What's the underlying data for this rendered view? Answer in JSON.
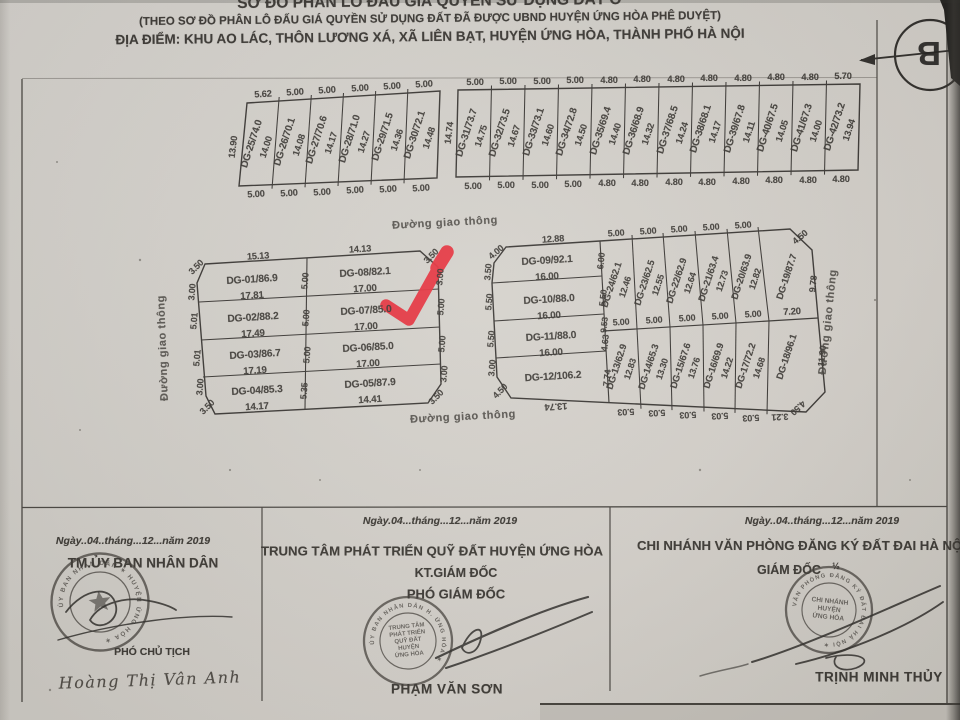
{
  "title": {
    "line1": "SƠ ĐỒ PHÂN LÔ ĐẤU GIÁ QUYỀN SỬ DỤNG ĐẤT Ở",
    "line2": "(THEO SƠ ĐỒ PHÂN LÔ ĐẤU GIÁ QUYỀN SỬ DỤNG ĐẤT ĐÃ ĐƯỢC UBND HUYỆN ỨNG HÒA PHÊ DUYỆT)",
    "line3": "ĐỊA ĐIỂM: KHU AO LÁC, THÔN LƯƠNG XÁ, XÃ LIÊN BẠT, HUYỆN ỨNG HÒA, THÀNH PHỐ HÀ NỘI"
  },
  "compass": {
    "north_label": "B"
  },
  "road_label": "Đường giao thông",
  "colors": {
    "paper": "#d7d3cd",
    "ink": "#3a3733",
    "red_mark": "#e6323e"
  },
  "blocks": {
    "top_left": {
      "left_dim": "13.90",
      "top_dims": [
        "5.62",
        "5.00",
        "5.00",
        "5.00",
        "5.00",
        "5.00"
      ],
      "bottom_dims": [
        "5.00",
        "5.00",
        "5.00",
        "5.00",
        "5.00",
        "5.00"
      ],
      "plots": [
        {
          "id": "DG-25/74.0",
          "depth": "14.00"
        },
        {
          "id": "DG-26/70.1",
          "depth": "14.08"
        },
        {
          "id": "DG-27/70.6",
          "depth": "14.17"
        },
        {
          "id": "DG-28/71.0",
          "depth": "14.27"
        },
        {
          "id": "DG-29/71.5",
          "depth": "14.36"
        },
        {
          "id": "DG-30/72.1",
          "depth": "14.48"
        }
      ]
    },
    "top_right": {
      "left_dim": "14.74",
      "top_dims": [
        "5.00",
        "5.00",
        "5.00",
        "5.00",
        "4.80",
        "4.80",
        "4.80",
        "4.80",
        "4.80",
        "4.80",
        "4.80",
        "5.70"
      ],
      "bottom_dims": [
        "5.00",
        "5.00",
        "5.00",
        "5.00",
        "4.80",
        "4.80",
        "4.80",
        "4.80",
        "4.80",
        "4.80",
        "4.80",
        "4.80"
      ],
      "plots": [
        {
          "id": "DG-31/73.7",
          "depth": "14.75"
        },
        {
          "id": "DG-32/73.5",
          "depth": "14.67"
        },
        {
          "id": "DG-33/73.1",
          "depth": "14.60"
        },
        {
          "id": "DG-34/72.8",
          "depth": "14.50"
        },
        {
          "id": "DG-35/69.4",
          "depth": "14.40"
        },
        {
          "id": "DG-36/68.9",
          "depth": "14.32"
        },
        {
          "id": "DG-37/68.5",
          "depth": "14.24"
        },
        {
          "id": "DG-38/68.1",
          "depth": "14.17"
        },
        {
          "id": "DG-39/67.8",
          "depth": "14.11"
        },
        {
          "id": "DG-40/67.5",
          "depth": "14.05"
        },
        {
          "id": "DG-41/67.3",
          "depth": "14.00"
        },
        {
          "id": "DG-42/73.2",
          "depth": "13.94"
        }
      ]
    },
    "mid_left": {
      "top_dims": [
        "15.13",
        "14.13"
      ],
      "left_col": [
        {
          "id": "DG-01/86.9",
          "w": "17.81"
        },
        {
          "id": "DG-02/88.2",
          "w": "17.49"
        },
        {
          "id": "DG-03/86.7",
          "w": "17.19"
        },
        {
          "id": "DG-04/85.3",
          "w": "14.17"
        }
      ],
      "right_col": [
        {
          "id": "DG-08/82.1",
          "w": "17.00"
        },
        {
          "id": "DG-07/85.0",
          "w": "17.00"
        },
        {
          "id": "DG-06/85.0",
          "w": "17.00"
        },
        {
          "id": "DG-05/87.9",
          "w": "14.41"
        }
      ],
      "left_dims": [
        "3.50",
        "3.00",
        "5.01",
        "5.01",
        "3.00",
        "3.50"
      ],
      "mid_dims": [
        "5.00",
        "5.00",
        "5.00",
        "5.35"
      ],
      "right_dims": [
        "3.50",
        "3.00",
        "5.00",
        "5.00",
        "3.00",
        "3.50"
      ]
    },
    "mid_right": {
      "top_dim": "12.88",
      "rows": [
        {
          "id": "DG-09/92.1",
          "w": "16.00"
        },
        {
          "id": "DG-10/88.0",
          "w": "16.00"
        },
        {
          "id": "DG-11/88.0",
          "w": "16.00"
        },
        {
          "id": "DG-12/106.2",
          "w": ""
        }
      ],
      "left_dims": [
        "4.00",
        "3.50",
        "5.50",
        "5.50",
        "3.00",
        "4.50"
      ],
      "divider_dims": [
        "6.00",
        "5.50",
        "9.53",
        "4.63",
        "7.74"
      ],
      "top_row": [
        {
          "id": "DG-24/62.1",
          "depth": "12.46"
        },
        {
          "id": "DG-23/62.5",
          "depth": "12.55"
        },
        {
          "id": "DG-22/62.9",
          "depth": "12.64"
        },
        {
          "id": "DG-21/63.4",
          "depth": "12.73"
        },
        {
          "id": "DG-20/63.9",
          "depth": "12.82"
        },
        {
          "id": "DG-19/87.7",
          "depth": "9.78"
        }
      ],
      "bottom_row": [
        {
          "id": "DG-13/62.9",
          "depth": "12.83"
        },
        {
          "id": "DG-14/65.3",
          "depth": "13.30"
        },
        {
          "id": "DG-15/67.6",
          "depth": "13.76"
        },
        {
          "id": "DG-16/69.9",
          "depth": "14.22"
        },
        {
          "id": "DG-17/72.2",
          "depth": "14.68"
        },
        {
          "id": "DG-18/96.1",
          "depth": "11.90"
        }
      ],
      "top_dims": [
        "5.00",
        "5.00",
        "5.00",
        "5.00",
        "5.00",
        "4.50"
      ],
      "mid_dims": [
        "5.00",
        "5.00",
        "5.00",
        "5.00",
        "5.00",
        "7.20"
      ],
      "bottom_dims": [
        "13.74",
        "5.03",
        "5.03",
        "5.03",
        "5.03",
        "5.03",
        "3.21",
        "4.50"
      ]
    }
  },
  "signatures": {
    "col1": {
      "date": "Ngày..04..tháng...12...năm 2019",
      "title": "TM.ỦY BAN NHÂN DÂN",
      "role": "PHÓ CHỦ TỊCH",
      "name": "Hoàng Thị Vân Anh",
      "stamp_ring": "ỦY BAN NHÂN DÂN ✶ HUYỆN ỨNG HÒA ✶"
    },
    "col2": {
      "date": "Ngày.04...tháng...12...năm 2019",
      "org": "TRUNG TÂM PHÁT TRIỂN QUỸ ĐẤT HUYỆN ỨNG HÒA",
      "role1": "KT.GIÁM ĐỐC",
      "role2": "PHÓ GIÁM ĐỐC",
      "name": "PHẠM VĂN SƠN",
      "stamp_lines": [
        "TRUNG TÂM",
        "PHÁT TRIỂN",
        "QUỸ ĐẤT",
        "HUYỆN",
        "ỨNG HÒA"
      ],
      "stamp_ring": "ỦY BAN NHÂN DÂN H. ỨNG HÒA ✶"
    },
    "col3": {
      "date": "Ngày..04..tháng...12...năm 2019",
      "org": "CHI NHÁNH VĂN PHÒNG ĐĂNG KÝ ĐẤT ĐAI HÀ NỘI H",
      "role": "GIÁM ĐỐC",
      "role_mark": "½",
      "name": "TRỊNH MINH THỦY",
      "stamp_lines": [
        "CHI NHÁNH",
        "HUYỆN",
        "ỨNG HÒA"
      ],
      "stamp_ring": "VĂN PHÒNG ĐĂNG KÝ ĐẤT ĐAI HÀ NỘI ✶"
    }
  }
}
